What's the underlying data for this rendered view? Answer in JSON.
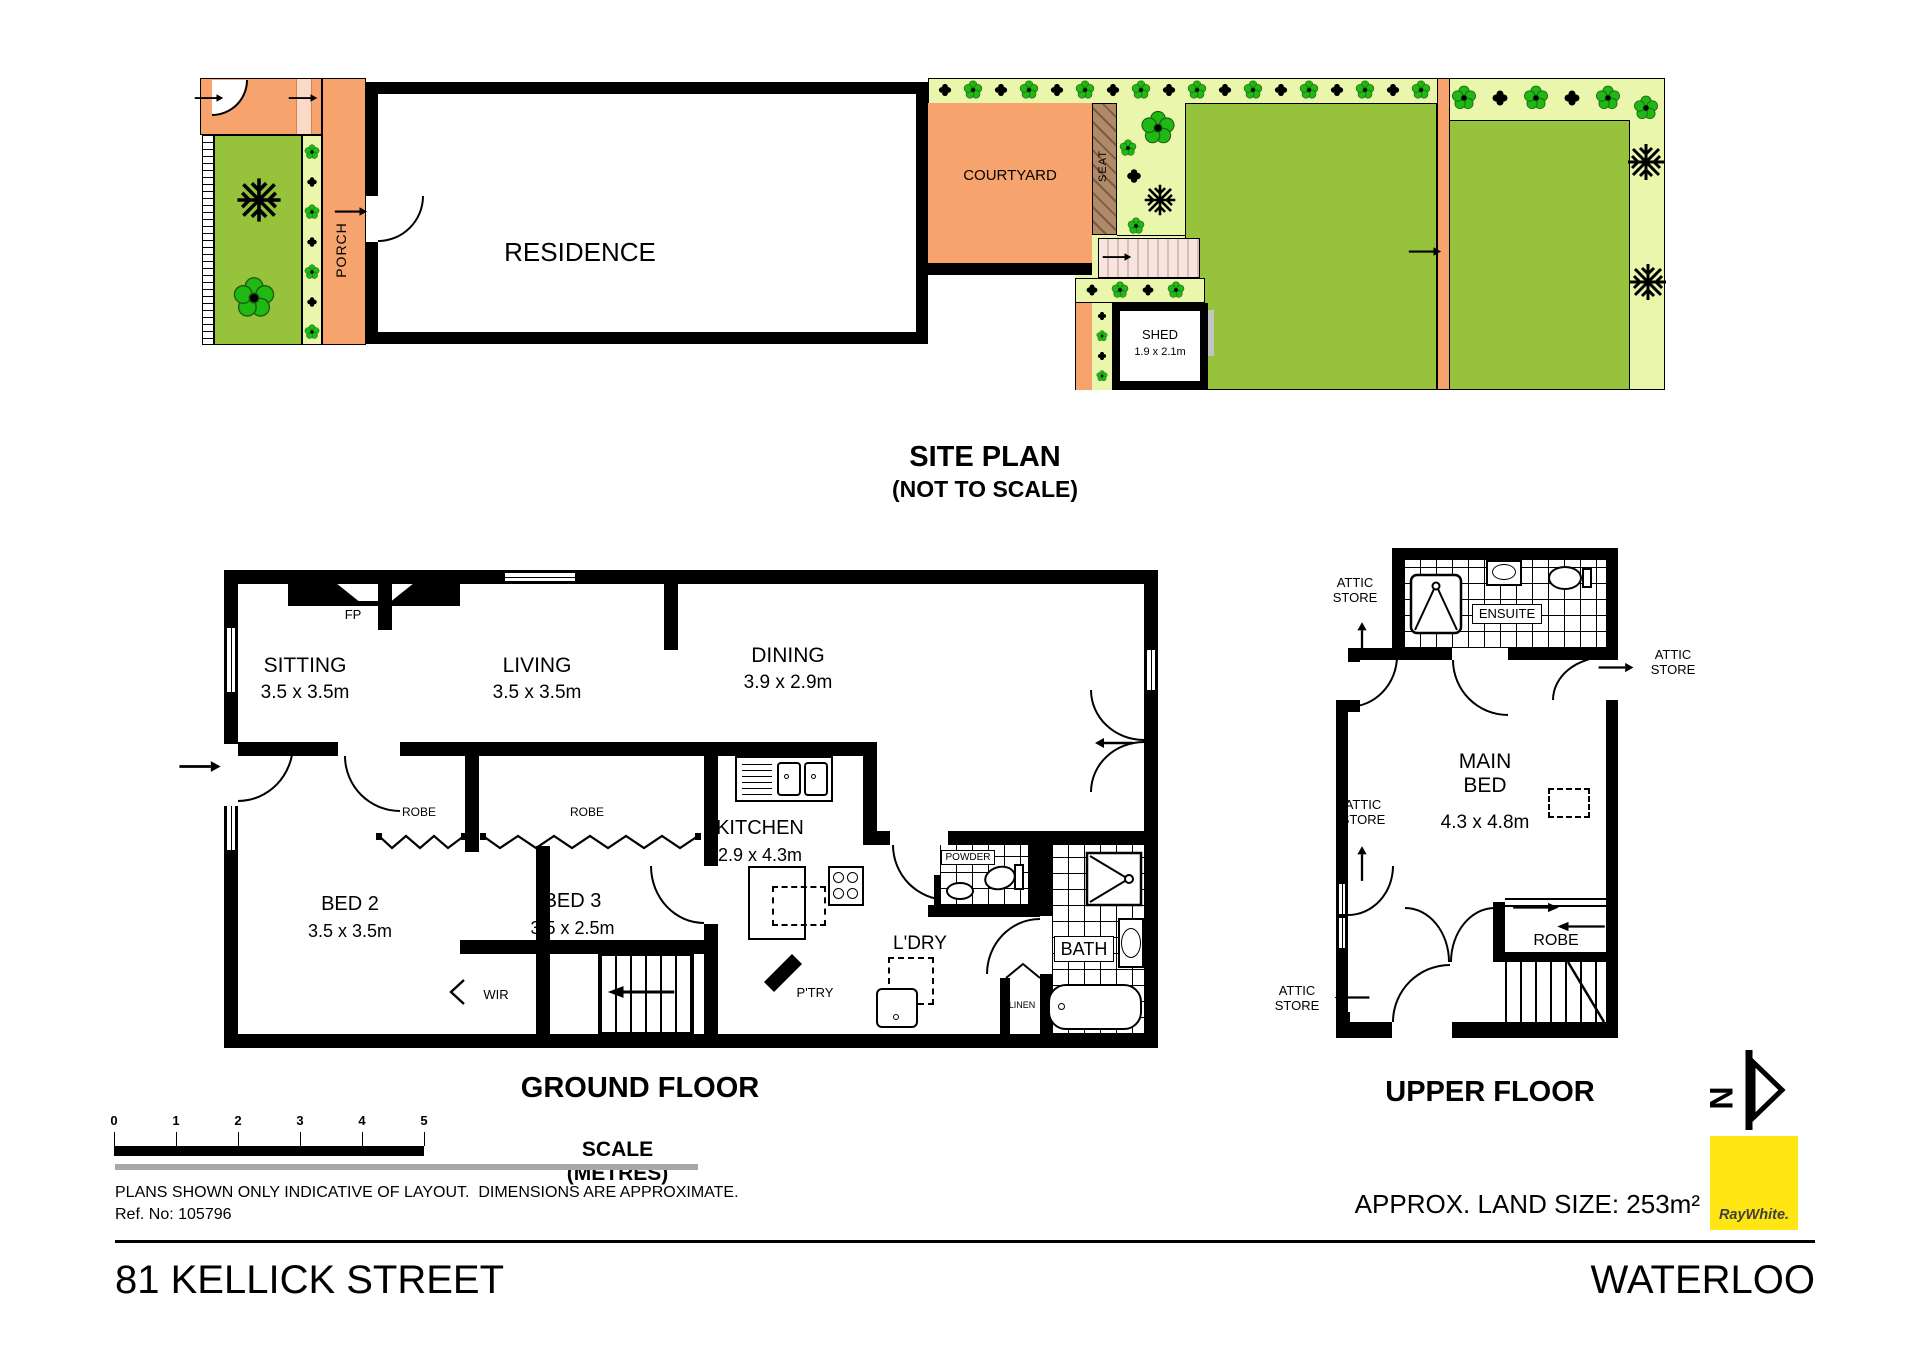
{
  "page": {
    "address": "81 KELLICK STREET",
    "suburb": "WATERLOO",
    "land_size": "APPROX. LAND SIZE: 253m²",
    "disclaimer": "PLANS SHOWN ONLY INDICATIVE OF LAYOUT.  DIMENSIONS ARE APPROXIMATE.",
    "ref": "Ref. No: 105796",
    "brand": "RayWhite.",
    "north": "N"
  },
  "site_plan": {
    "title": "SITE PLAN",
    "subtitle": "(NOT TO SCALE)",
    "residence": "RESIDENCE",
    "porch": "PORCH",
    "courtyard": "COURTYARD",
    "seat": "SEAT",
    "shed": "SHED",
    "shed_dims": "1.9 x 2.1m"
  },
  "ground_floor": {
    "title": "GROUND FLOOR",
    "sitting": {
      "name": "SITTING",
      "dims": "3.5 x 3.5m"
    },
    "living": {
      "name": "LIVING",
      "dims": "3.5 x 3.5m"
    },
    "dining": {
      "name": "DINING",
      "dims": "3.9 x 2.9m"
    },
    "kitchen": {
      "name": "KITCHEN",
      "dims": "2.9 x 4.3m"
    },
    "bed2": {
      "name": "BED 2",
      "dims": "3.5 x 3.5m"
    },
    "bed3": {
      "name": "BED 3",
      "dims": "3.5 x 2.5m"
    },
    "fp": "FP",
    "robe": "ROBE",
    "wir": "WIR",
    "ldry": "L'DRY",
    "bath": "BATH",
    "ptry": "P'TRY",
    "powder": "POWDER",
    "linen": "LINEN"
  },
  "upper_floor": {
    "title": "UPPER FLOOR",
    "main_bed": {
      "name": "MAIN BED",
      "dims": "4.3 x 4.8m"
    },
    "ensuite": "ENSUITE",
    "robe": "ROBE",
    "attic_store": "ATTIC STORE"
  },
  "scale_bar": {
    "ticks": [
      "0",
      "1",
      "2",
      "3",
      "4",
      "5"
    ],
    "caption": "SCALE (METRES)"
  },
  "icons": {
    "flower-icon": "five-petal garden flower",
    "fern-icon": "dark spiky plant",
    "cross-icon": "clover shrub",
    "north-arrow-icon": "north arrow pointing right",
    "door-arc-icon": "door swing arc"
  },
  "colors": {
    "wall": "#000000",
    "orange": "#F7A36E",
    "lawn": "#96C23C",
    "garden_border": "#EBF6AD",
    "seat_brown": "#B08A68",
    "path_pink": "#F7E4DE",
    "scale_gray": "#A8A8A8",
    "brand_yellow": "#FFE512"
  }
}
